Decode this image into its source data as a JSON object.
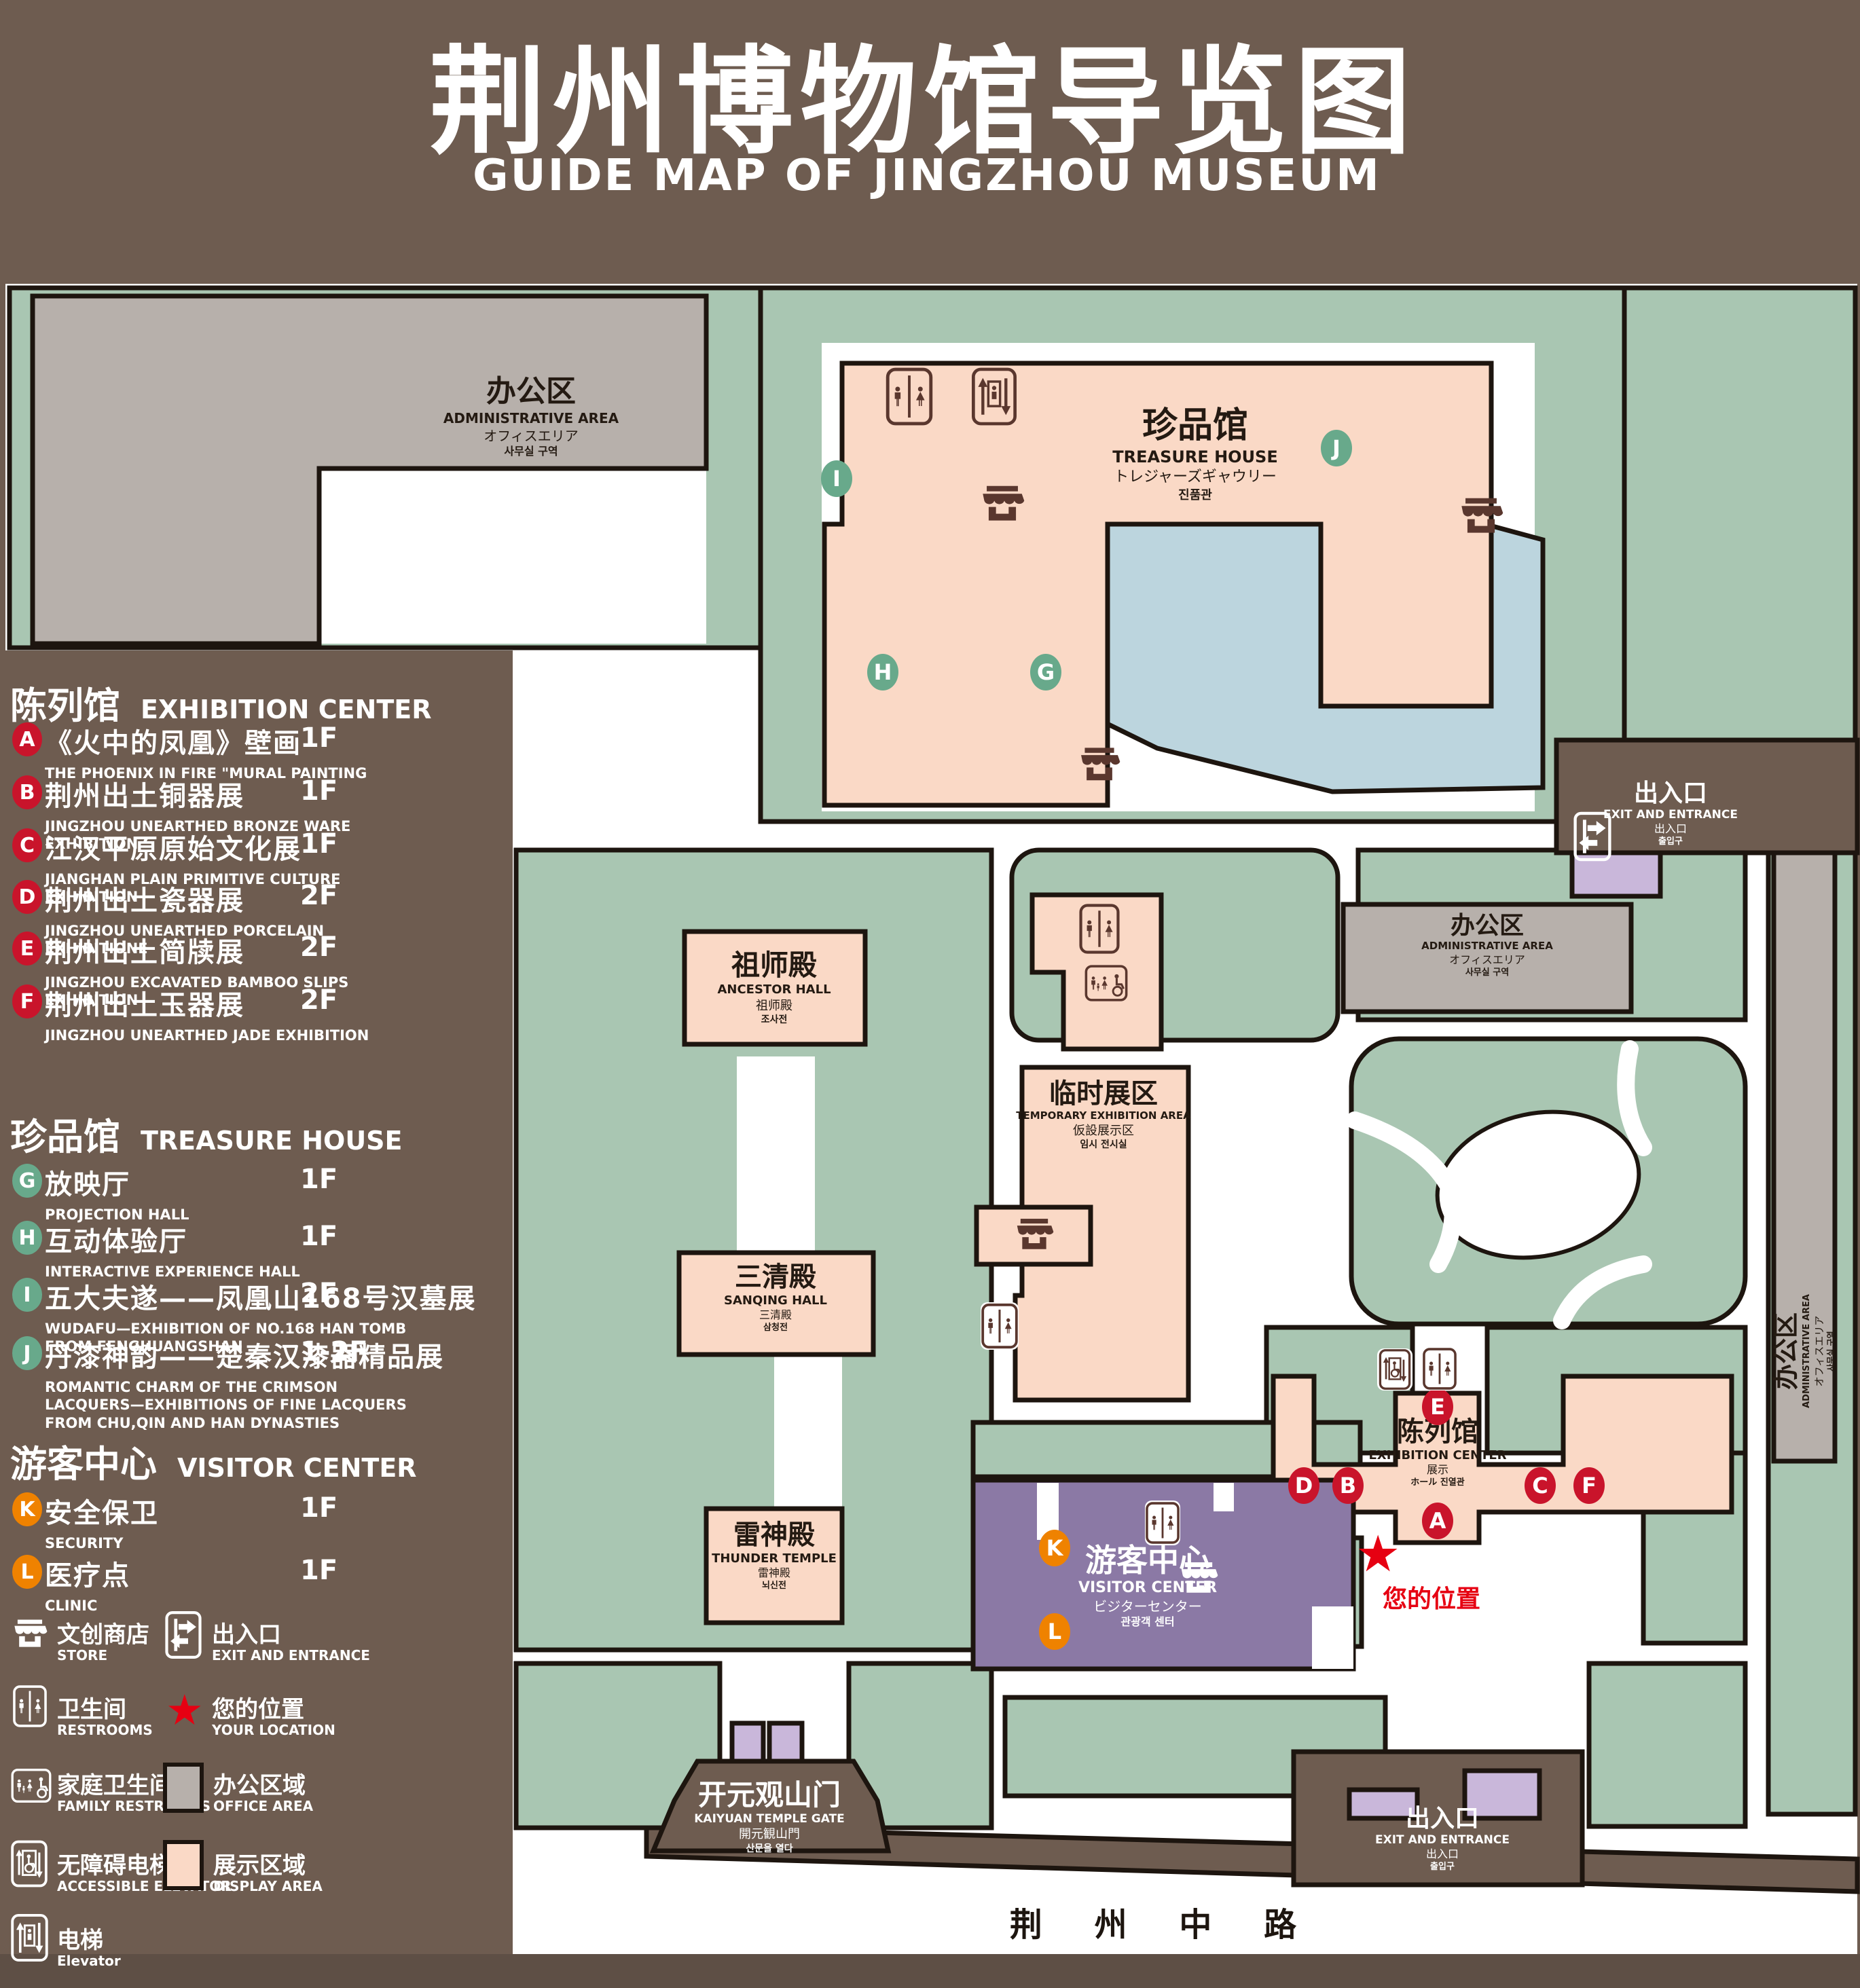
{
  "title": {
    "zh": "荆州博物馆导览图",
    "en": "GUIDE MAP OF JINGZHOU MUSEUM"
  },
  "legend": {
    "sections": [
      {
        "zh": "陈列馆",
        "en": "EXHIBITION CENTER",
        "items": [
          {
            "letter": "A",
            "zh": "《火中的凤凰》壁画",
            "en": "THE PHOENIX IN FIRE \"MURAL PAINTING",
            "floor": "1F"
          },
          {
            "letter": "B",
            "zh": "荆州出土铜器展",
            "en": "JINGZHOU UNEARTHED BRONZE WARE EXHIBITION",
            "floor": "1F"
          },
          {
            "letter": "C",
            "zh": "江汉平原原始文化展",
            "en": "JIANGHAN PLAIN PRIMITIVE CULTURE EXHIBITION",
            "floor": "1F"
          },
          {
            "letter": "D",
            "zh": "荆州出土瓷器展",
            "en": "JINGZHOU UNEARTHED PORCELAIN EXHIBITIONE",
            "floor": "2F"
          },
          {
            "letter": "E",
            "zh": "荆州出土简牍展",
            "en": "JINGZHOU EXCAVATED BAMBOO SLIPS EXHIBITION",
            "floor": "2F"
          },
          {
            "letter": "F",
            "zh": "荆州出土玉器展",
            "en": "JINGZHOU UNEARTHED JADE EXHIBITION",
            "floor": "2F"
          }
        ]
      },
      {
        "zh": "珍品馆",
        "en": "TREASURE HOUSE",
        "items": [
          {
            "letter": "G",
            "zh": "放映厅",
            "en": "PROJECTION HALL",
            "floor": "1F"
          },
          {
            "letter": "H",
            "zh": "互动体验厅",
            "en": "INTERACTIVE EXPERIENCE HALL",
            "floor": "1F"
          },
          {
            "letter": "I",
            "zh": "五大夫遂——凤凰山168号汉墓展",
            "en": "WUDAFU—EXHIBITION OF NO.168 HAN TOMB FROM FENGHUANGSHAN",
            "floor": "2F"
          },
          {
            "letter": "J",
            "zh": "丹漆神韵——楚秦汉漆器精品展",
            "en": "ROMANTIC CHARM OF THE CRIMSON LACQUERS—EXHIBITIONS OF FINE LACQUERS FROM CHU,QIN AND HAN DYNASTIES",
            "floor": "1-2F"
          }
        ]
      },
      {
        "zh": "游客中心",
        "en": "VISITOR CENTER",
        "items": [
          {
            "letter": "K",
            "zh": "安全保卫",
            "en": "SECURITY",
            "floor": "1F"
          },
          {
            "letter": "L",
            "zh": "医疗点",
            "en": "CLINIC",
            "floor": "1F"
          }
        ]
      }
    ],
    "symbols": [
      {
        "icon": "store-icon",
        "zh": "文创商店",
        "en": "STORE"
      },
      {
        "icon": "exit-icon",
        "zh": "出入口",
        "en": "EXIT AND ENTRANCE"
      },
      {
        "icon": "restroom-icon",
        "zh": "卫生间",
        "en": "RESTROOMS"
      },
      {
        "icon": "location-star-icon",
        "zh": "您的位置",
        "en": "YOUR LOCATION"
      },
      {
        "icon": "family-restroom-icon",
        "zh": "家庭卫生间",
        "en": "FAMILY RESTROOMS"
      },
      {
        "icon": "office-swatch",
        "zh": "办公区域",
        "en": "OFFICE AREA"
      },
      {
        "icon": "accessible-elevator-icon",
        "zh": "无障碍电梯",
        "en": "ACCESSIBLE ELEVATOR"
      },
      {
        "icon": "display-swatch",
        "zh": "展示区域",
        "en": "DISPLAY AREA"
      },
      {
        "icon": "elevator-icon",
        "zh": "电梯",
        "en": "Elevator"
      }
    ]
  },
  "map": {
    "buildings": {
      "admin": {
        "zh": "办公区",
        "en": "ADMINISTRATIVE AREA",
        "jp": "オフィスエリア",
        "kr": "사무실 구역"
      },
      "treasure": {
        "zh": "珍品馆",
        "en": "TREASURE HOUSE",
        "jp": "トレジャーズギャウリー",
        "kr": "진품관"
      },
      "ancestor": {
        "zh": "祖师殿",
        "en": "ANCESTOR HALL",
        "jp": "祖师殿",
        "kr": "조사전"
      },
      "temporary": {
        "zh": "临时展区",
        "en": "TEMPORARY EXHIBITION AREA",
        "jp": "仮設展示区",
        "kr": "임시 전시실"
      },
      "sanqing": {
        "zh": "三清殿",
        "en": "SANQING HALL",
        "jp": "三清殿",
        "kr": "삼청전"
      },
      "thunder": {
        "zh": "雷神殿",
        "en": "THUNDER TEMPLE",
        "jp": "雷神殿",
        "kr": "뇌신전"
      },
      "visitor": {
        "zh": "游客中心",
        "en": "VISITOR CENTER",
        "jp": "ビジターセンター",
        "kr": "관광객 센터"
      },
      "exhibition": {
        "zh": "陈列馆",
        "en": "EXHIBITION CENTER",
        "jp": "展示",
        "kr": "ホール 진열관"
      },
      "gate": {
        "zh": "开元观山门",
        "en": "KAIYUAN TEMPLE GATE",
        "jp": "開元観山門",
        "kr": "산문을 열다"
      }
    },
    "exit": {
      "zh": "出入口",
      "en": "EXIT AND ENTRANCE",
      "jp": "出入口",
      "kr": "출입구"
    },
    "your_location": {
      "zh": "您的位置",
      "star": "★"
    },
    "road": {
      "name": "荆 州 中 路"
    },
    "markers": {
      "a": "A",
      "b": "B",
      "c": "C",
      "d": "D",
      "e": "E",
      "f": "F",
      "g": "G",
      "h": "H",
      "i": "I",
      "j": "J",
      "k": "K",
      "l": "L"
    }
  },
  "colors": {
    "bg": "#6E5C50",
    "green": "#A9C6B2",
    "pink": "#FAD9C6",
    "gray": "#B7B0AB",
    "lake": "#BCD5DE",
    "purple": "#8B79A5",
    "purple-light": "#C9B7DA",
    "red": "#C9142B",
    "marker-green": "#68A98B",
    "orange": "#EF8200",
    "star-red": "#E60012",
    "icon-dark": "#5A372E",
    "outline": "#1D150F"
  }
}
